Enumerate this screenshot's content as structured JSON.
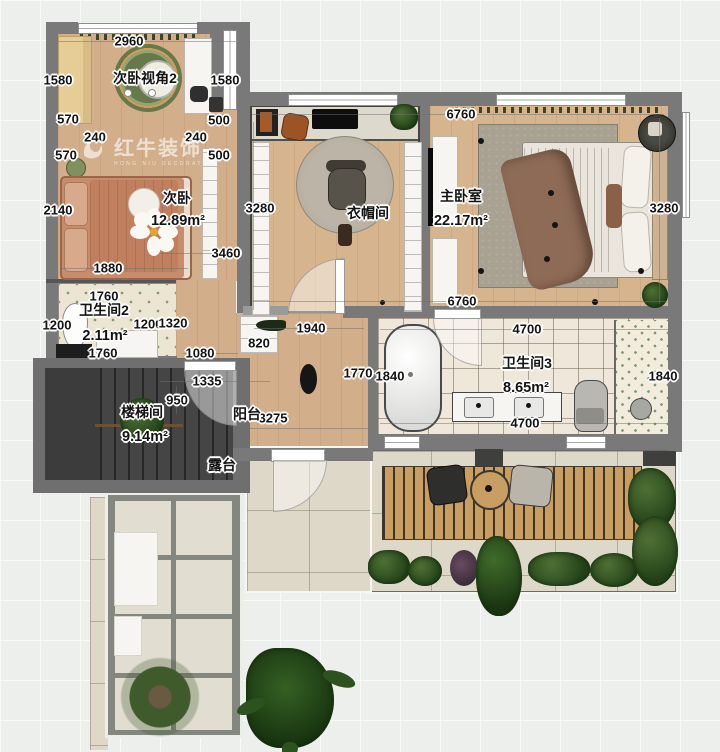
{
  "watermark": {
    "brand": "红牛装饰",
    "subtitle": "HONG NIU DECORATION"
  },
  "rooms": [
    {
      "label": "次卧视角2",
      "lx": 145,
      "ly": 78
    },
    {
      "label": "次卧",
      "lx": 177,
      "ly": 198,
      "area": "12.89m²",
      "ax": 178,
      "ay": 221
    },
    {
      "label": "衣帽间",
      "lx": 368,
      "ly": 213
    },
    {
      "label": "主卧室",
      "lx": 461,
      "ly": 196,
      "area": "22.17m²",
      "ax": 461,
      "ay": 221
    },
    {
      "label": "卫生间2",
      "lx": 104,
      "ly": 310,
      "area": "2.11m²",
      "ax": 105,
      "ay": 336
    },
    {
      "label": "卫生间3",
      "lx": 527,
      "ly": 363,
      "area": "8.65m²",
      "ax": 526,
      "ay": 388
    },
    {
      "label": "楼梯间",
      "lx": 142,
      "ly": 412,
      "area": "9.14m²",
      "ax": 145,
      "ay": 437
    },
    {
      "label": "阳台",
      "lx": 247,
      "ly": 414
    },
    {
      "label": "露台",
      "lx": 222,
      "ly": 465
    }
  ],
  "dimensions": [
    {
      "v": "2960",
      "x": 129,
      "y": 41
    },
    {
      "v": "1580",
      "x": 58,
      "y": 80
    },
    {
      "v": "1580",
      "x": 225,
      "y": 80
    },
    {
      "v": "570",
      "x": 68,
      "y": 119
    },
    {
      "v": "500",
      "x": 219,
      "y": 120
    },
    {
      "v": "240",
      "x": 95,
      "y": 137
    },
    {
      "v": "240",
      "x": 196,
      "y": 137
    },
    {
      "v": "570",
      "x": 66,
      "y": 155
    },
    {
      "v": "500",
      "x": 219,
      "y": 155
    },
    {
      "v": "2140",
      "x": 58,
      "y": 210
    },
    {
      "v": "3460",
      "x": 226,
      "y": 253
    },
    {
      "v": "1880",
      "x": 108,
      "y": 268
    },
    {
      "v": "3280",
      "x": 260,
      "y": 208
    },
    {
      "v": "6760",
      "x": 461,
      "y": 114
    },
    {
      "v": "3280",
      "x": 664,
      "y": 208
    },
    {
      "v": "6760",
      "x": 462,
      "y": 301
    },
    {
      "v": "1760",
      "x": 104,
      "y": 296
    },
    {
      "v": "1200",
      "x": 57,
      "y": 325
    },
    {
      "v": "1200",
      "x": 148,
      "y": 324
    },
    {
      "v": "1320",
      "x": 173,
      "y": 323
    },
    {
      "v": "1760",
      "x": 103,
      "y": 353
    },
    {
      "v": "1080",
      "x": 200,
      "y": 353
    },
    {
      "v": "820",
      "x": 259,
      "y": 343
    },
    {
      "v": "1940",
      "x": 311,
      "y": 328
    },
    {
      "v": "1335",
      "x": 207,
      "y": 381
    },
    {
      "v": "950",
      "x": 177,
      "y": 400
    },
    {
      "v": "3275",
      "x": 273,
      "y": 418
    },
    {
      "v": "1770",
      "x": 358,
      "y": 373
    },
    {
      "v": "1840",
      "x": 390,
      "y": 376
    },
    {
      "v": "4700",
      "x": 527,
      "y": 329
    },
    {
      "v": "4700",
      "x": 525,
      "y": 423
    },
    {
      "v": "1840",
      "x": 663,
      "y": 376
    }
  ]
}
